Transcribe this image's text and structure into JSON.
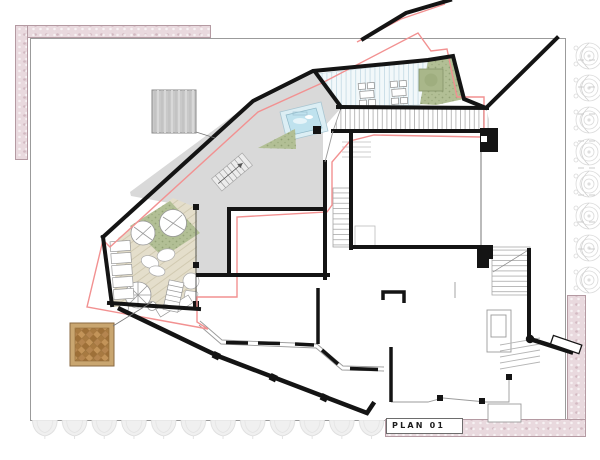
{
  "title_block": {
    "label": "PLAN 01"
  },
  "palette": {
    "outline_red": "#f29191",
    "wall_black": "#141414",
    "floor_gray": "#d9d9d9",
    "deck_beige": "#e4decb",
    "lawn_green": "#b2bf95",
    "pool_blue": "#bfe2ee",
    "striped_deck": "#f2f8fa",
    "border_pink": "#e9d9de",
    "parquet_brown": "#b5854f",
    "stone_gray": "#c9c9c9"
  },
  "materials": [
    {
      "id": "stone-texture-swatch"
    },
    {
      "id": "wood-parquet-swatch"
    }
  ]
}
